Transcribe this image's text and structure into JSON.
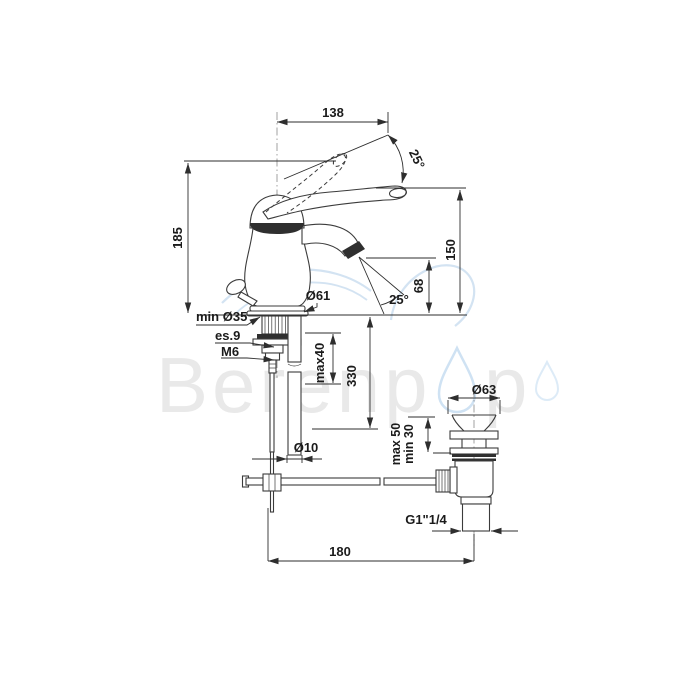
{
  "watermark": {
    "brand_left": "Berenp",
    "brand_right": "p"
  },
  "dims": {
    "reach": "138",
    "handle_angle": "25°",
    "total_height": "185",
    "spout_height": "150",
    "outlet_height": "68",
    "outlet_angle": "25°",
    "base_dia": "Ø61",
    "min_hole": "min Ø35",
    "hex": "es.9",
    "thread": "M6",
    "max_deck": "max40",
    "pipe_len": "330",
    "pipe_dia": "Ø10",
    "drain_max": "max 50",
    "drain_min": "min 30",
    "cap_dia": "Ø63",
    "drain_thread": "G1\"1/4",
    "spacing": "180"
  },
  "colors": {
    "line": "#3b3b3b",
    "text": "#1b1b1b",
    "watermark_gray": "#e9e9e9",
    "watermark_blue": "#cfe2f3"
  }
}
